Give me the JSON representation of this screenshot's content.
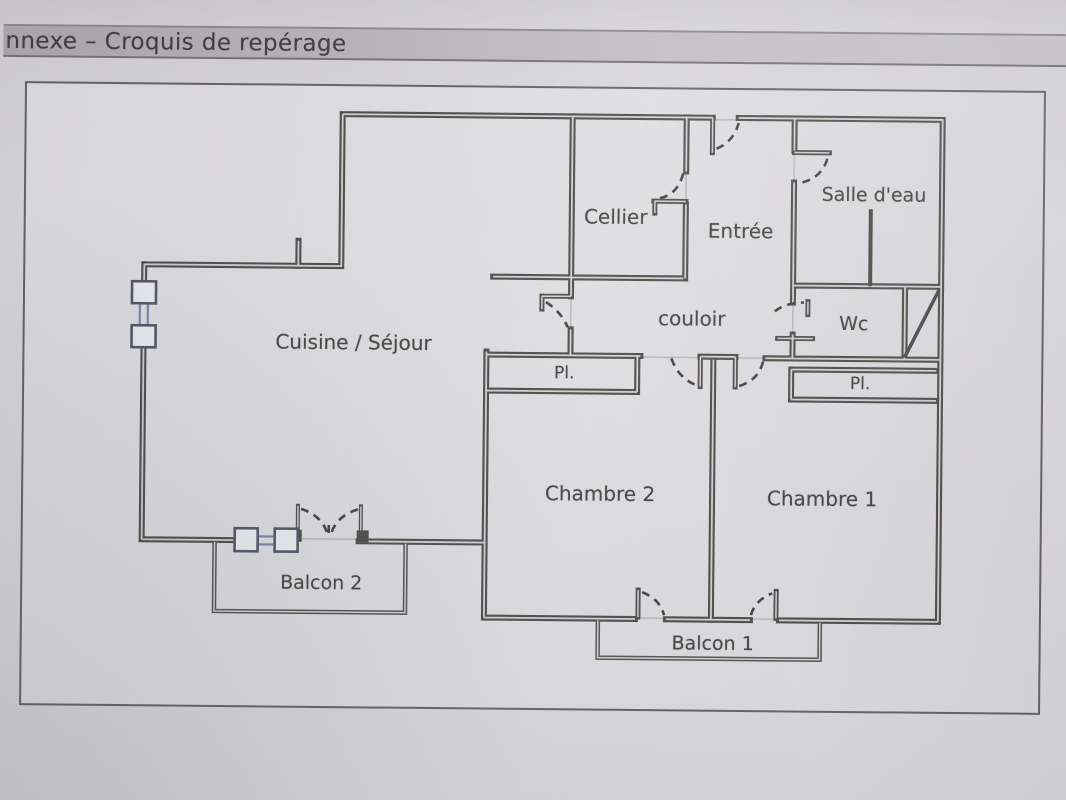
{
  "header": {
    "title": "nnexe – Croquis de repérage"
  },
  "plan": {
    "rooms": [
      {
        "id": "cellier",
        "label": "Cellier"
      },
      {
        "id": "entree",
        "label": "Entrée"
      },
      {
        "id": "salle-deau",
        "label": "Salle d'eau"
      },
      {
        "id": "cuisine-sejour",
        "label": "Cuisine / Séjour"
      },
      {
        "id": "couloir",
        "label": "couloir"
      },
      {
        "id": "wc",
        "label": "Wc"
      },
      {
        "id": "placard-chambre-2",
        "label": "Pl."
      },
      {
        "id": "placard-chambre-1",
        "label": "Pl."
      },
      {
        "id": "chambre-2",
        "label": "Chambre 2"
      },
      {
        "id": "chambre-1",
        "label": "Chambre 1"
      },
      {
        "id": "balcon-2",
        "label": "Balcon 2"
      },
      {
        "id": "balcon-1",
        "label": "Balcon 1"
      }
    ],
    "colors": {
      "wall": "#4b4a45",
      "wall_core": "#d0cfd3",
      "paper": "#dcdbdf",
      "title_bar": "#b5b2b5",
      "window_accent": "#7b85a8",
      "label_text": "#42413d"
    }
  }
}
